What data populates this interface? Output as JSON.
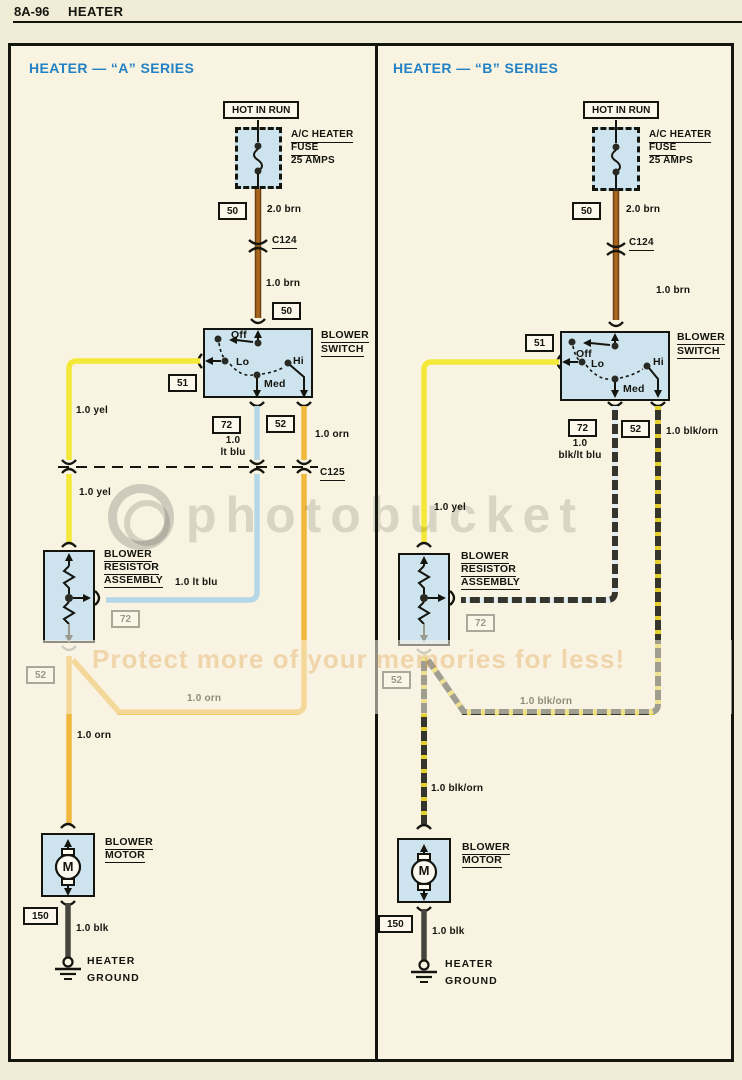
{
  "page": {
    "code": "8A-96",
    "title": "HEATER"
  },
  "watermark": {
    "brand": "photobucket",
    "slogan": "Protect more of your memories for less!"
  },
  "colors": {
    "accent_title": "#2381c4",
    "component_fill": "#cde4ef",
    "wire_brown": "#a8661f",
    "wire_yellow": "#f4e838",
    "wire_light_blue": "#b5d8e9",
    "wire_orange": "#f0b93e",
    "wire_black": "#46463e"
  },
  "panels": [
    {
      "series": "A",
      "title": "HEATER — “A” SERIES",
      "power": "HOT IN RUN",
      "fuse": {
        "name1": "A/C HEATER",
        "name2": "FUSE",
        "rating": "25 AMPS"
      },
      "connector_c124": "C124",
      "connector_c125": "C125",
      "circuit_50": "50",
      "circuit_51": "51",
      "circuit_72": "72",
      "circuit_52": "52",
      "circuit_150": "150",
      "wire_feed": "2.0 brn",
      "wire_brn": "1.0 brn",
      "wire_yel": "1.0 yel",
      "wire_med_1": "1.0",
      "wire_med_2": "lt blu",
      "wire_med_full": "1.0 lt blu",
      "wire_hi": "1.0 orn",
      "wire_blk": "1.0 blk",
      "switch": {
        "name1": "BLOWER",
        "name2": "SWITCH",
        "pos_off": "Off",
        "pos_lo": "Lo",
        "pos_med": "Med",
        "pos_hi": "Hi"
      },
      "resistor": {
        "name1": "BLOWER",
        "name2": "RESISTOR",
        "name3": "ASSEMBLY"
      },
      "motor": {
        "name1": "BLOWER",
        "name2": "MOTOR",
        "symbol": "M"
      },
      "ground": {
        "name1": "HEATER",
        "name2": "GROUND"
      }
    },
    {
      "series": "B",
      "title": "HEATER — “B” SERIES",
      "power": "HOT IN RUN",
      "fuse": {
        "name1": "A/C HEATER",
        "name2": "FUSE",
        "rating": "25 AMPS"
      },
      "connector_c124": "C124",
      "circuit_50": "50",
      "circuit_51": "51",
      "circuit_72": "72",
      "circuit_52": "52",
      "circuit_150": "150",
      "wire_feed": "2.0 brn",
      "wire_brn": "1.0 brn",
      "wire_yel": "1.0 yel",
      "wire_med_1": "1.0",
      "wire_med_2": "blk/lt blu",
      "wire_hi": "1.0 blk/orn",
      "wire_blk": "1.0 blk",
      "switch": {
        "name1": "BLOWER",
        "name2": "SWITCH",
        "pos_off": "Off",
        "pos_lo": "Lo",
        "pos_med": "Med",
        "pos_hi": "Hi"
      },
      "resistor": {
        "name1": "BLOWER",
        "name2": "RESISTOR",
        "name3": "ASSEMBLY"
      },
      "motor": {
        "name1": "BLOWER",
        "name2": "MOTOR",
        "symbol": "M"
      },
      "ground": {
        "name1": "HEATER",
        "name2": "GROUND"
      }
    }
  ]
}
